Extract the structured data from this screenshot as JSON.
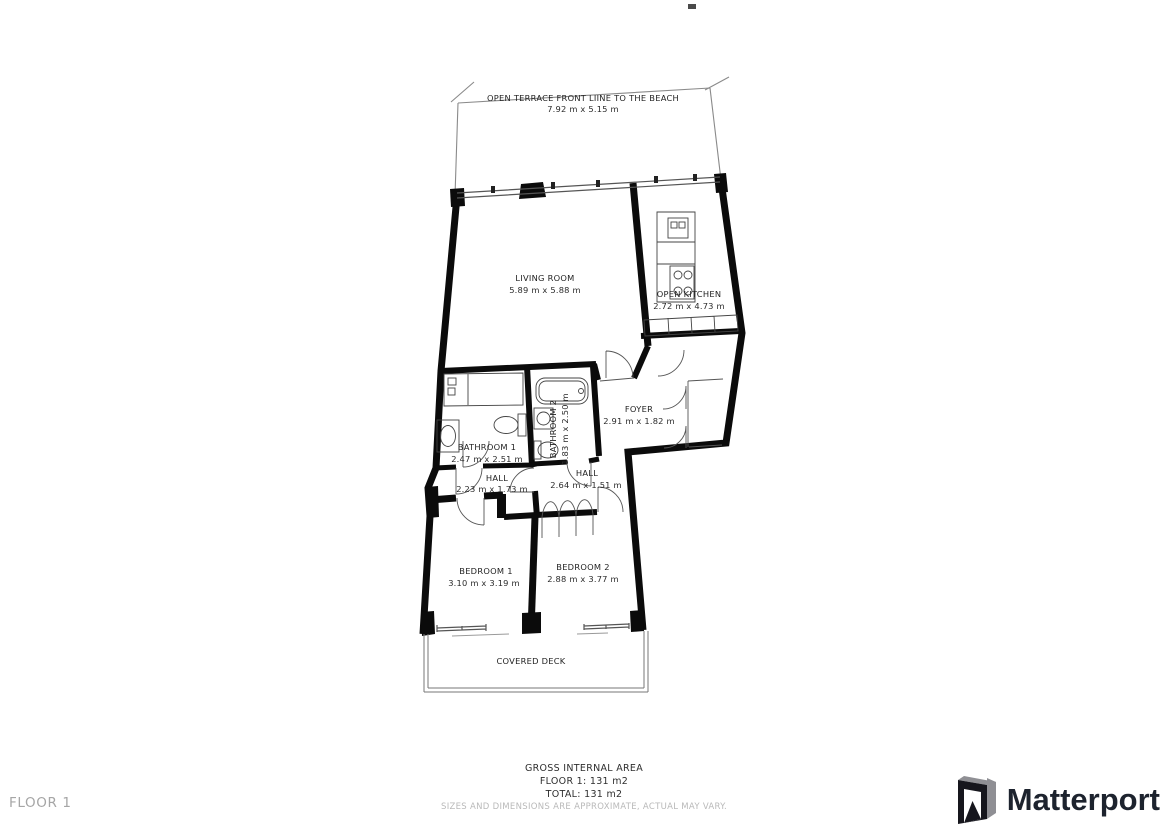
{
  "plan": {
    "rooms": {
      "terrace": {
        "name": "OPEN TERRACE FRONT LIINE TO THE BEACH",
        "dims": "7.92 m x 5.15 m"
      },
      "living_room": {
        "name": "LIVING ROOM",
        "dims": "5.89 m x 5.88 m"
      },
      "open_kitchen": {
        "name": "OPEN KITCHEN",
        "dims": "2.72 m x 4.73 m"
      },
      "foyer": {
        "name": "FOYER",
        "dims": "2.91 m x 1.82 m"
      },
      "bathroom_1": {
        "name": "BATHROOM 1",
        "dims": "2.47 m x 2.51 m"
      },
      "bathroom_2": {
        "name": "BATHROOM 2",
        "dims": "1.83 m x 2.50 m"
      },
      "hall_1": {
        "name": "HALL",
        "dims": "2.23 m x 1.73 m"
      },
      "hall_2": {
        "name": "HALL",
        "dims": "2.64 m x 1.51 m"
      },
      "bedroom_1": {
        "name": "BEDROOM 1",
        "dims": "3.10 m x 3.19 m"
      },
      "bedroom_2": {
        "name": "BEDROOM 2",
        "dims": "2.88 m x 3.77 m"
      },
      "covered_deck": {
        "name": "COVERED DECK"
      }
    }
  },
  "footer": {
    "floor_label": "FLOOR 1",
    "gross_internal_area": "GROSS INTERNAL AREA",
    "floor_area_line": "FLOOR 1: 131 m2",
    "total_area_line": "TOTAL: 131 m2",
    "disclaimer": "SIZES AND DIMENSIONS ARE APPROXIMATE, ACTUAL MAY VARY."
  },
  "brand": {
    "name": "Matterport"
  },
  "colors": {
    "wall": "#0b0b0b",
    "thin_line": "#555555",
    "terrace_line": "#8a8a8a",
    "label_text": "#1f1f1f",
    "muted_text": "#b9b9b9",
    "floor_chip_text": "#a6a6a6",
    "brand_text": "#1d232e"
  }
}
